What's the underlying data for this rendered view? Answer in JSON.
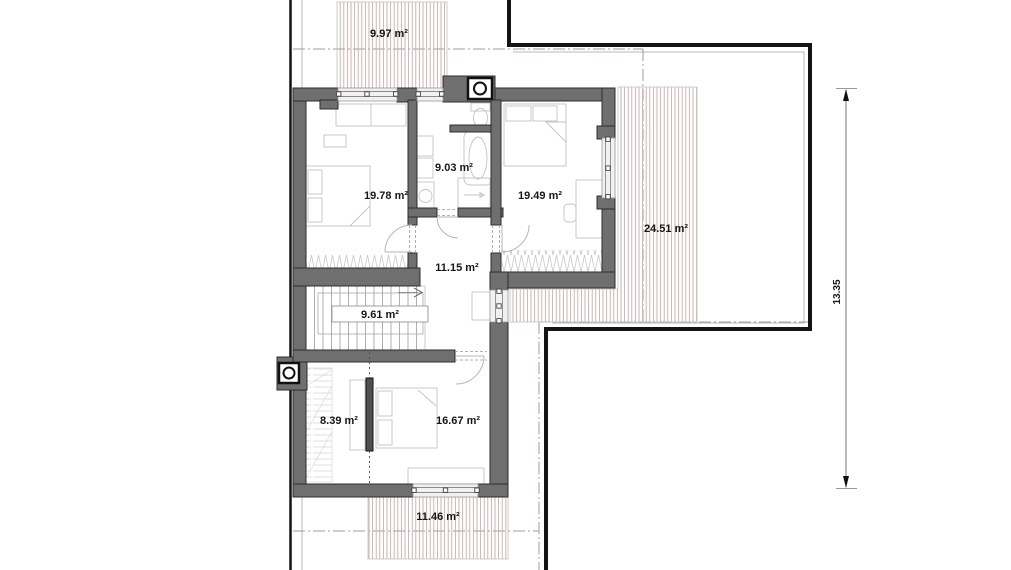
{
  "plan": {
    "type": "architectural-floor-plan",
    "rooms": [
      {
        "name": "terrace-top",
        "area_label": "9.97 m²"
      },
      {
        "name": "bedroom-left",
        "area_label": "19.78 m²"
      },
      {
        "name": "bathroom",
        "area_label": "9.03 m²"
      },
      {
        "name": "bedroom-right",
        "area_label": "19.49 m²"
      },
      {
        "name": "terrace-right",
        "area_label": "24.51 m²"
      },
      {
        "name": "hallway",
        "area_label": "11.15 m²"
      },
      {
        "name": "staircase",
        "area_label": "9.61 m²"
      },
      {
        "name": "closet",
        "area_label": "8.39 m²"
      },
      {
        "name": "bedroom-bottom",
        "area_label": "16.67 m²"
      },
      {
        "name": "terrace-bottom",
        "area_label": "11.46 m²"
      }
    ],
    "dimension": {
      "value": "13.35"
    },
    "icons": [
      {
        "name": "chimney-icon-top"
      },
      {
        "name": "chimney-icon-left"
      }
    ],
    "colors": {
      "wall": "#6f6f6f",
      "outline": "#141414",
      "hatch": "#cfaaaa",
      "centerline": "#a89890",
      "furniture": "#c3c3c3",
      "text": "#161616"
    }
  }
}
